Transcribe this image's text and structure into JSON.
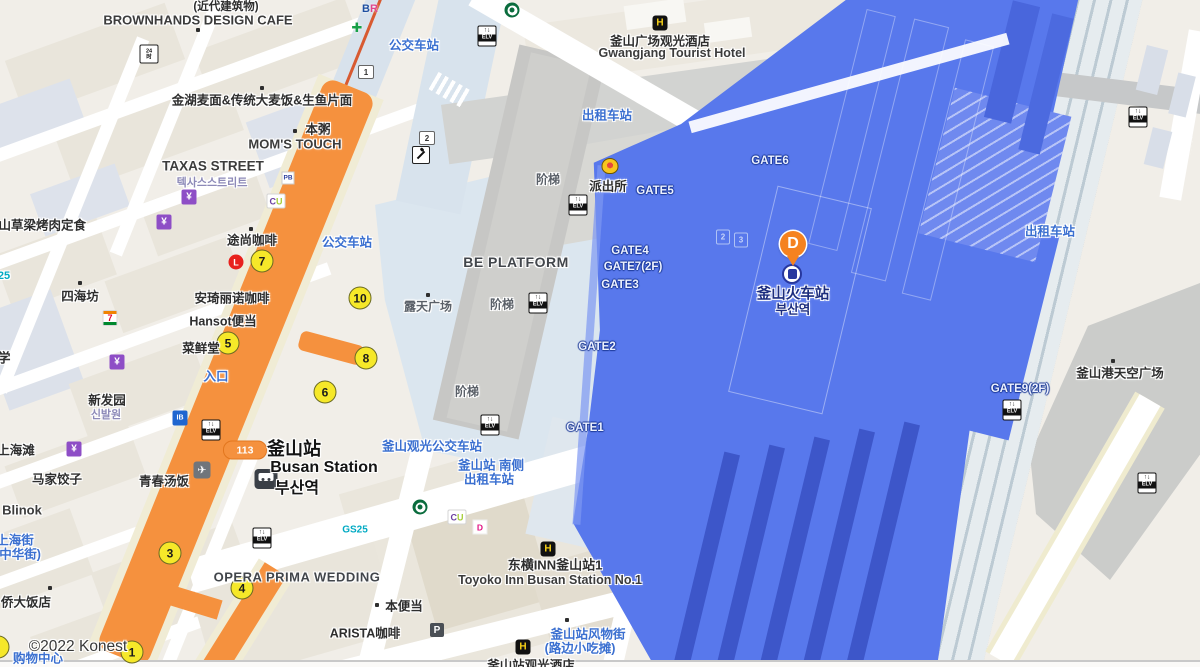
{
  "attribution": "©2022 Konest",
  "colors": {
    "road_orange": "#F5913E",
    "station_blue": "#5878EC",
    "platform_dark": "#3D56C9",
    "plaza_blue": "#DBE6EF",
    "exit_yellow": "#F6E829",
    "poi_blue_text": "#3A6FD0",
    "navy_station_text": "#1B2C7E",
    "deck_gray": "#C7C7C5"
  },
  "marker": {
    "label": "D",
    "x": 793,
    "y": 268
  },
  "route_badge": {
    "text": "113",
    "x": 245,
    "y": 450
  },
  "labels": [
    {
      "id": "modern-bldg",
      "text": "(近代建筑物)",
      "x": 226,
      "y": 6,
      "cls": "cn",
      "s": 11.5
    },
    {
      "id": "brownhands",
      "text": "BROWNHANDS DESIGN CAFE",
      "x": 198,
      "y": 20,
      "cls": "en",
      "s": 13
    },
    {
      "id": "jinhu-noodle",
      "text": "金湖麦面&传统大麦饭&生鱼片面",
      "x": 262,
      "y": 99,
      "cls": "cn"
    },
    {
      "id": "bonjuk",
      "text": "本粥",
      "x": 318,
      "y": 128,
      "cls": "cn"
    },
    {
      "id": "moms-touch",
      "text": "MOM'S TOUCH",
      "x": 295,
      "y": 144,
      "cls": "en",
      "s": 13
    },
    {
      "id": "taxas-street",
      "text": "TAXAS STREET",
      "x": 213,
      "y": 166,
      "cls": "en",
      "s": 13.5
    },
    {
      "id": "taxas-street-kr",
      "text": "텍사스스트리트",
      "x": 212,
      "y": 182,
      "cls": "kr"
    },
    {
      "id": "bus-stop-top",
      "text": "公交车站",
      "x": 414,
      "y": 44,
      "cls": "blue"
    },
    {
      "id": "gwangjang-cn",
      "text": "釜山广场观光酒店",
      "x": 660,
      "y": 40,
      "cls": "cn"
    },
    {
      "id": "gwangjang-en",
      "text": "Gwangjang Tourist Hotel",
      "x": 672,
      "y": 53,
      "cls": "en",
      "s": 12.5
    },
    {
      "id": "taxi-stand-top",
      "text": "出租车站",
      "x": 607,
      "y": 114,
      "cls": "blue"
    },
    {
      "id": "police-box",
      "text": "派出所",
      "x": 608,
      "y": 185,
      "cls": "cn"
    },
    {
      "id": "gate6",
      "text": "GATE6",
      "x": 770,
      "y": 161,
      "cls": "gate"
    },
    {
      "id": "gate5",
      "text": "GATE5",
      "x": 655,
      "y": 191,
      "cls": "gate"
    },
    {
      "id": "gate4",
      "text": "GATE4",
      "x": 630,
      "y": 251,
      "cls": "gate"
    },
    {
      "id": "gate7-2f",
      "text": "GATE7(2F)",
      "x": 633,
      "y": 267,
      "cls": "gate"
    },
    {
      "id": "gate3",
      "text": "GATE3",
      "x": 620,
      "y": 285,
      "cls": "gate"
    },
    {
      "id": "gate2",
      "text": "GATE2",
      "x": 597,
      "y": 347,
      "cls": "gate"
    },
    {
      "id": "gate1",
      "text": "GATE1",
      "x": 585,
      "y": 428,
      "cls": "gate"
    },
    {
      "id": "gate9-2f",
      "text": "GATE9(2F)",
      "x": 1020,
      "y": 389,
      "cls": "gate"
    },
    {
      "id": "busan-rail-cn",
      "text": "釜山火车站",
      "x": 793,
      "y": 293,
      "cls": "navy1"
    },
    {
      "id": "busan-rail-kr",
      "text": "부산역",
      "x": 793,
      "y": 308,
      "cls": "navy2"
    },
    {
      "id": "be-platform",
      "text": "BE PLATFORM",
      "x": 516,
      "y": 262,
      "cls": "deck"
    },
    {
      "id": "stairs-1",
      "text": "阶梯",
      "x": 548,
      "y": 179,
      "cls": "gray"
    },
    {
      "id": "stairs-2",
      "text": "阶梯",
      "x": 502,
      "y": 304,
      "cls": "gray"
    },
    {
      "id": "stairs-3",
      "text": "阶梯",
      "x": 467,
      "y": 391,
      "cls": "gray"
    },
    {
      "id": "open-plaza",
      "text": "露天广场",
      "x": 428,
      "y": 306,
      "cls": "gray"
    },
    {
      "id": "bus-stop-mid",
      "text": "公交车站",
      "x": 347,
      "y": 241,
      "cls": "blue"
    },
    {
      "id": "tous-cafe",
      "text": "途尚咖啡",
      "x": 252,
      "y": 239,
      "cls": "cn"
    },
    {
      "id": "angelinus",
      "text": "安琦丽诺咖啡",
      "x": 232,
      "y": 297,
      "cls": "cn"
    },
    {
      "id": "hansot",
      "text": "Hansot便当",
      "x": 223,
      "y": 320,
      "cls": "cn"
    },
    {
      "id": "caixiantang",
      "text": "菜鲜堂",
      "x": 201,
      "y": 347,
      "cls": "cn"
    },
    {
      "id": "entrance",
      "text": "入口",
      "x": 216,
      "y": 375,
      "cls": "blue"
    },
    {
      "id": "xinfayuan",
      "text": "新发园",
      "x": 107,
      "y": 399,
      "cls": "cn"
    },
    {
      "id": "xinfayuan-kr",
      "text": "신발원",
      "x": 106,
      "y": 414,
      "cls": "kr"
    },
    {
      "id": "sihaifang",
      "text": "四海坊",
      "x": 80,
      "y": 295,
      "cls": "cn"
    },
    {
      "id": "caoliang-bbq",
      "text": "釜山草梁烤肉定食",
      "x": 36,
      "y": 224,
      "cls": "cn"
    },
    {
      "id": "gs25-partial",
      "text": "25",
      "x": 4,
      "y": 276,
      "cls": "teal"
    },
    {
      "id": "school-partial",
      "text": "学",
      "x": 4,
      "y": 357,
      "cls": "cn",
      "s": 13
    },
    {
      "id": "shanghaitan",
      "text": "上海滩",
      "x": 16,
      "y": 449,
      "cls": "cn"
    },
    {
      "id": "majia-dumpling",
      "text": "马家饺子",
      "x": 57,
      "y": 478,
      "cls": "cn"
    },
    {
      "id": "qingchun-soup",
      "text": "青春汤饭",
      "x": 164,
      "y": 480,
      "cls": "cn"
    },
    {
      "id": "blinok",
      "text": "Blinok",
      "x": 22,
      "y": 510,
      "cls": "en",
      "s": 13
    },
    {
      "id": "shanghai-st",
      "text": "上海街",
      "x": 15,
      "y": 539,
      "cls": "blue"
    },
    {
      "id": "shanghai-st2",
      "text": "(中华街)",
      "x": 18,
      "y": 553,
      "cls": "blue"
    },
    {
      "id": "qiaoda-hotel",
      "text": "侨大饭店",
      "x": 26,
      "y": 601,
      "cls": "cn"
    },
    {
      "id": "opera-wedding",
      "text": "OPERA PRIMA WEDDING",
      "x": 297,
      "y": 577,
      "cls": "deck",
      "s": 13
    },
    {
      "id": "busan-station-cn",
      "text": "釜山站",
      "x": 294,
      "y": 448,
      "cls": "big"
    },
    {
      "id": "busan-station-en",
      "text": "Busan Station",
      "x": 324,
      "y": 468,
      "cls": "big2"
    },
    {
      "id": "busan-station-kr",
      "text": "부산역",
      "x": 297,
      "y": 486,
      "cls": "big2"
    },
    {
      "id": "tour-bus-stop",
      "text": "釜山观光公交车站",
      "x": 432,
      "y": 445,
      "cls": "blue"
    },
    {
      "id": "south-side-1",
      "text": "釜山站 南侧",
      "x": 491,
      "y": 464,
      "cls": "blue"
    },
    {
      "id": "south-side-2",
      "text": "出租车站",
      "x": 489,
      "y": 478,
      "cls": "blue"
    },
    {
      "id": "toyoko-cn",
      "text": "东横INN釜山站1",
      "x": 555,
      "y": 564,
      "cls": "cn",
      "s": 13
    },
    {
      "id": "toyoko-en",
      "text": "Toyoko Inn Busan Station No.1",
      "x": 550,
      "y": 580,
      "cls": "en",
      "s": 12.5
    },
    {
      "id": "fengwu-street",
      "text": "釜山站风物街",
      "x": 588,
      "y": 633,
      "cls": "blue",
      "s": 12.5
    },
    {
      "id": "fengwu-street2",
      "text": "(路边小吃摊)",
      "x": 580,
      "y": 647,
      "cls": "blue"
    },
    {
      "id": "south-hotel",
      "text": "釜山站观光酒店",
      "x": 531,
      "y": 664,
      "cls": "cn"
    },
    {
      "id": "bon-dosirak",
      "text": "本便当",
      "x": 404,
      "y": 605,
      "cls": "cn"
    },
    {
      "id": "arista-cafe",
      "text": "ARISTA咖啡",
      "x": 365,
      "y": 632,
      "cls": "cn"
    },
    {
      "id": "sky-plaza",
      "text": "釜山港天空广场",
      "x": 1120,
      "y": 372,
      "cls": "cn",
      "s": 12.5
    },
    {
      "id": "taxi-stand-right",
      "text": "出租车站",
      "x": 1050,
      "y": 230,
      "cls": "blue"
    },
    {
      "id": "shopping-partial",
      "text": "购物中心",
      "x": 38,
      "y": 657,
      "cls": "blue"
    }
  ],
  "dots": [
    [
      198,
      30
    ],
    [
      262,
      88
    ],
    [
      295,
      131
    ],
    [
      251,
      229
    ],
    [
      80,
      283
    ],
    [
      428,
      295
    ],
    [
      1113,
      361
    ],
    [
      377,
      605
    ],
    [
      50,
      588
    ],
    [
      567,
      620
    ]
  ],
  "exits": [
    {
      "n": "7",
      "x": 262,
      "y": 261
    },
    {
      "n": "10",
      "x": 360,
      "y": 298
    },
    {
      "n": "8",
      "x": 366,
      "y": 358
    },
    {
      "n": "6",
      "x": 325,
      "y": 392
    },
    {
      "n": "5",
      "x": 228,
      "y": 343
    },
    {
      "n": "3",
      "x": 170,
      "y": 553
    },
    {
      "n": "4",
      "x": 242,
      "y": 588
    },
    {
      "n": "1",
      "x": 132,
      "y": 652
    },
    {
      "n": "",
      "x": -2,
      "y": 647
    }
  ],
  "icons": [
    {
      "type": "elv",
      "x": 487,
      "y": 36
    },
    {
      "type": "elv",
      "x": 578,
      "y": 205
    },
    {
      "type": "elv",
      "x": 538,
      "y": 303
    },
    {
      "type": "elv",
      "x": 490,
      "y": 425
    },
    {
      "type": "elv",
      "x": 211,
      "y": 430
    },
    {
      "type": "elv",
      "x": 262,
      "y": 538
    },
    {
      "type": "elv",
      "x": 1138,
      "y": 117
    },
    {
      "type": "elv",
      "x": 1012,
      "y": 410
    },
    {
      "type": "elv",
      "x": 1147,
      "y": 483
    },
    {
      "type": "hotel",
      "x": 660,
      "y": 23
    },
    {
      "type": "hotel",
      "x": 548,
      "y": 549
    },
    {
      "type": "hotel",
      "x": 523,
      "y": 647
    },
    {
      "type": "starbucks",
      "x": 512,
      "y": 10
    },
    {
      "type": "starbucks",
      "x": 420,
      "y": 507
    },
    {
      "type": "cu",
      "x": 276,
      "y": 201
    },
    {
      "type": "cu",
      "x": 457,
      "y": 517
    },
    {
      "type": "paris-baguette",
      "x": 288,
      "y": 178
    },
    {
      "type": "baskin-robbins",
      "x": 370,
      "y": 9
    },
    {
      "type": "pharmacy-cross",
      "x": 357,
      "y": 28
    },
    {
      "type": "seven-eleven",
      "x": 110,
      "y": 318
    },
    {
      "type": "gs25",
      "x": 355,
      "y": 530
    },
    {
      "type": "dunkin",
      "x": 480,
      "y": 527
    },
    {
      "type": "police",
      "x": 610,
      "y": 166
    },
    {
      "type": "ktx-train",
      "x": 792,
      "y": 274
    },
    {
      "type": "subway",
      "x": 266,
      "y": 479
    },
    {
      "type": "airport-bus",
      "x": 202,
      "y": 470
    },
    {
      "type": "bank",
      "x": 180,
      "y": 418
    },
    {
      "type": "lotteria",
      "x": 236,
      "y": 262
    },
    {
      "type": "parking",
      "x": 437,
      "y": 630
    },
    {
      "type": "open24",
      "x": 149,
      "y": 54
    },
    {
      "type": "escalator",
      "x": 421,
      "y": 155
    },
    {
      "type": "numbox",
      "text": "1",
      "x": 366,
      "y": 72
    },
    {
      "type": "numbox",
      "text": "2",
      "x": 427,
      "y": 138
    },
    {
      "type": "platform-box",
      "text": "2",
      "x": 723,
      "y": 237
    },
    {
      "type": "platform-box",
      "text": "3",
      "x": 741,
      "y": 240
    },
    {
      "type": "currency-exchange",
      "x": 189,
      "y": 197
    },
    {
      "type": "currency-exchange",
      "x": 164,
      "y": 222
    },
    {
      "type": "currency-exchange",
      "x": 117,
      "y": 362
    },
    {
      "type": "currency-exchange",
      "x": 74,
      "y": 449
    }
  ]
}
